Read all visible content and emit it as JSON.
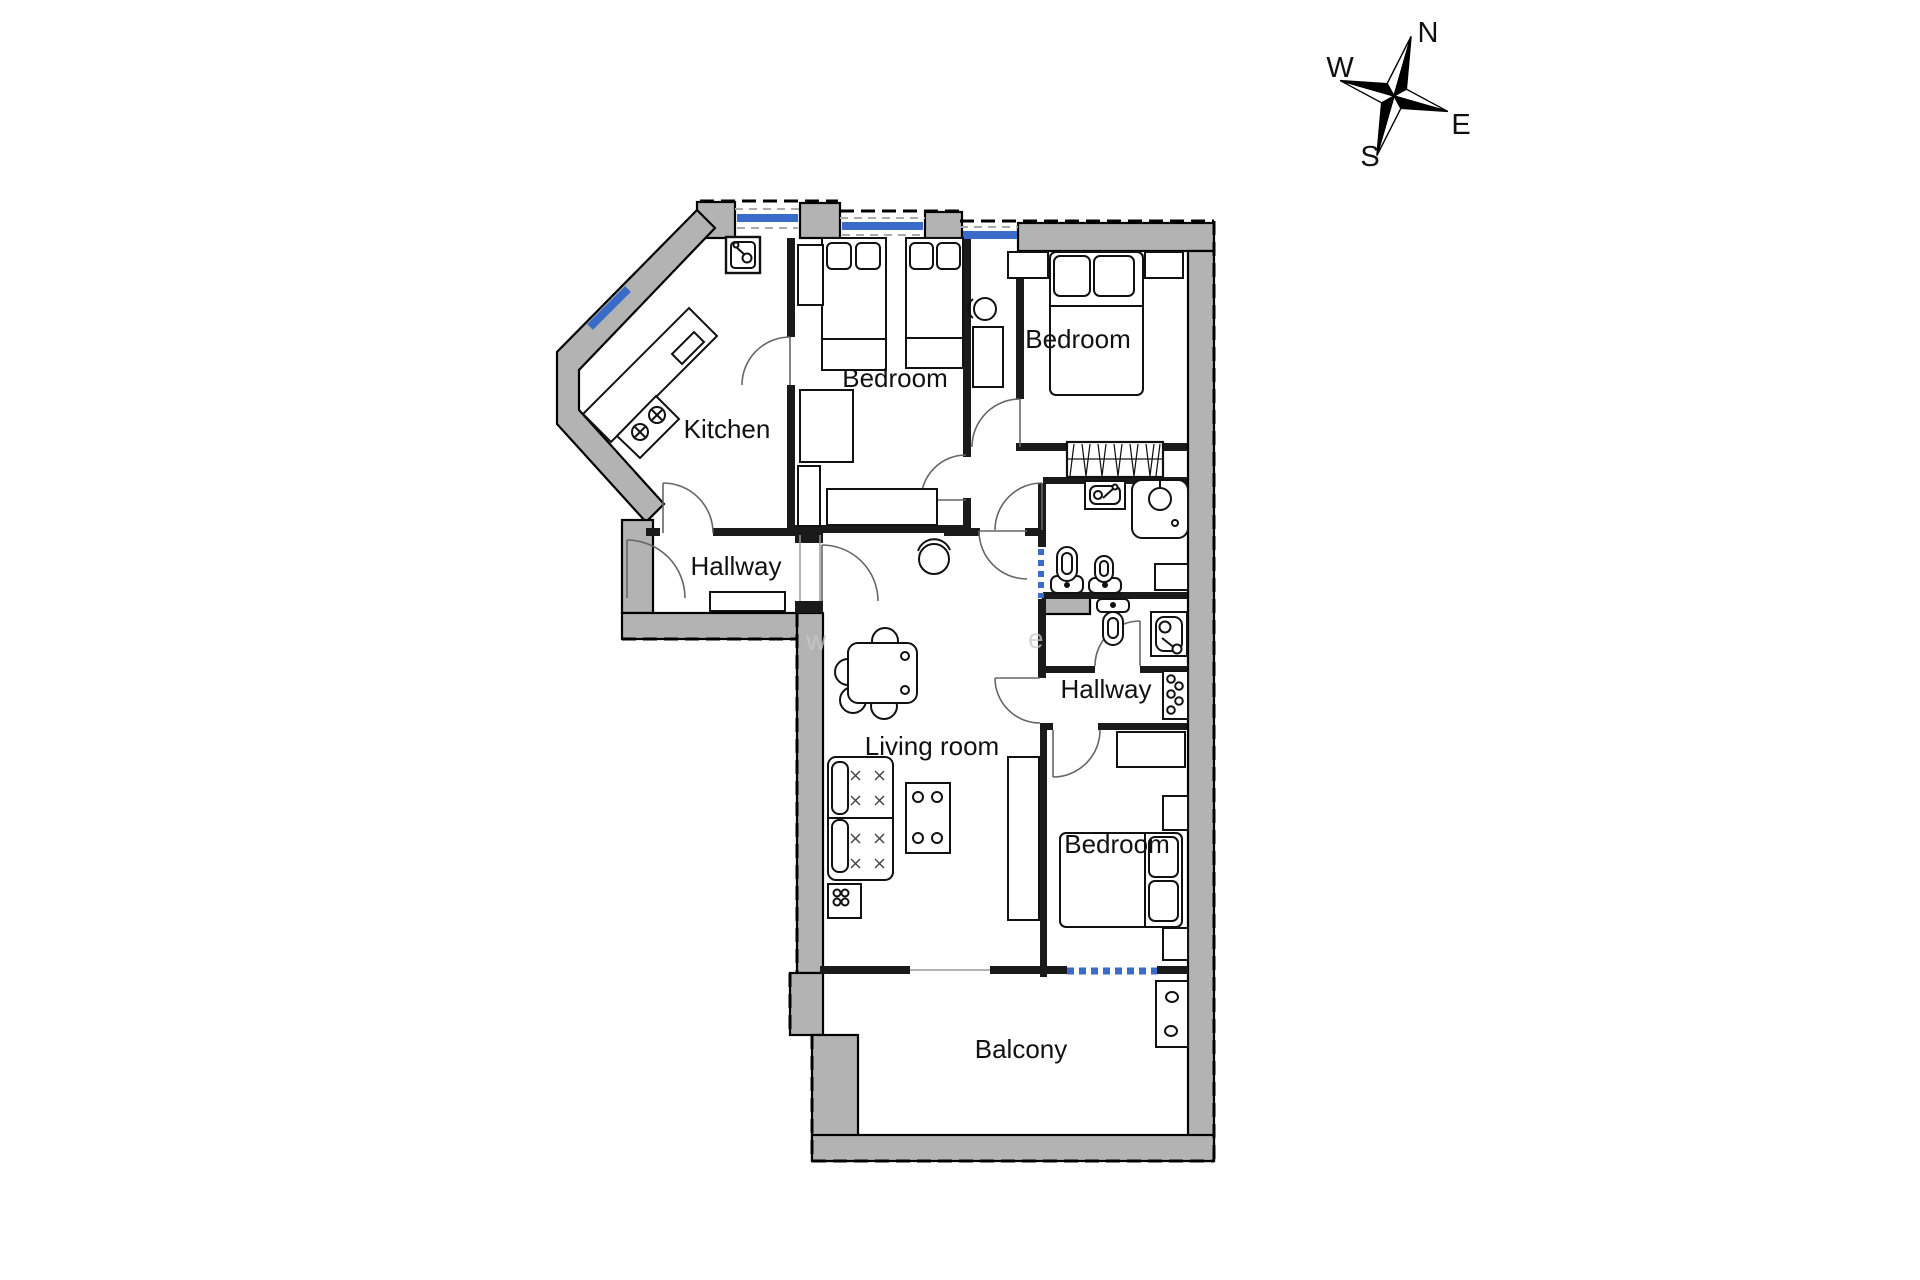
{
  "compass": {
    "north": "N",
    "east": "E",
    "south": "S",
    "west": "W"
  },
  "rooms": {
    "kitchen": "Kitchen",
    "bedroom_top_left": "Bedroom",
    "bedroom_top_right": "Bedroom",
    "hallway_left": "Hallway",
    "hallway_right": "Hallway",
    "living_room": "Living room",
    "bedroom_bottom": "Bedroom",
    "balcony": "Balcony"
  },
  "watermark": {
    "fragment_left": "w",
    "fragment_right": "e"
  },
  "colors": {
    "wall_fill": "#b3b3b3",
    "window_blue": "#3a6bc9",
    "outline": "#000000",
    "door_arc": "#666666"
  }
}
